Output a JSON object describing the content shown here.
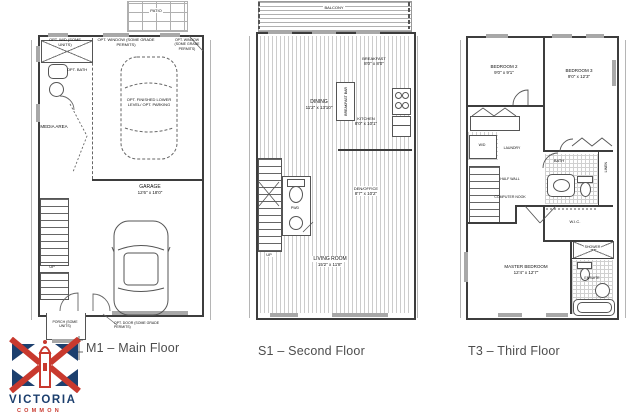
{
  "titles": {
    "m1": "M1 – Main Floor",
    "s1": "S1 – Second Floor",
    "t3": "T3 – Third Floor"
  },
  "m1": {
    "patio": "PATIO",
    "opt_wd": "OPT. W/D (SOME UNITS)",
    "opt_window": "OPT. WINDOW (SOME GRADE PERMITS)",
    "opt_window2": "OPT. WINDOW (SOME GRADE PERMITS)",
    "opt_bath": "OPT. BATH",
    "media": "MEDIA AREA",
    "opt_lower": "OPT. FINISHED LOWER LEVEL/ OPT. PARKING",
    "garage_name": "GARAGE",
    "garage_dims": "12'6\" x 18'0\"",
    "opt_door": "OPT. DOOR (SOME GRADE PERMITS)",
    "porch": "PORCH (SOME UNITS)",
    "up": "UP"
  },
  "s1": {
    "balcony": "BALCONY",
    "dining_name": "DINING",
    "dining_dims": "11'2\" x 13'10\"",
    "breakfast_bar": "BREAKFAST BAR",
    "breakfast_name": "BREAKFAST",
    "breakfast_dims": "8'0\" x 8'0\"",
    "kitchen_name": "KITCHEN",
    "kitchen_dims": "8'0\" x 10'1\"",
    "den_name": "DEN/OFFICE",
    "den_dims": "8'7\" x 10'2\"",
    "pwd": "PWD",
    "up": "UP",
    "living_name": "LIVING ROOM",
    "living_dims": "15'2\" x 11'8\""
  },
  "t3": {
    "bed2_name": "BEDROOM 2",
    "bed2_dims": "9'0\" x 9'1\"",
    "bed3_name": "BEDROOM 3",
    "bed3_dims": "9'0\" x 12'3\"",
    "wd": "W/D",
    "laundry": "LAUNDRY",
    "bath": "BATH",
    "linen": "LINEN",
    "half_wall": "HALF WALL",
    "computer_nook": "COMPUTER NOOK",
    "wic": "W.I.C.",
    "master_name": "MASTER BEDROOM",
    "master_dims": "12'4\" x 12'7\"",
    "shower": "SHOWER",
    "ensuite": "ENSUITE"
  },
  "logo": {
    "name": "VICTORIA",
    "sub": "COMMON"
  },
  "colors": {
    "wall": "#3d3d3d",
    "window_fill": "#a8a8a8",
    "hatch": "#cccccc",
    "title_text": "#4d4d4d",
    "logo_navy": "#1c3f6e",
    "logo_red": "#c8392e"
  }
}
